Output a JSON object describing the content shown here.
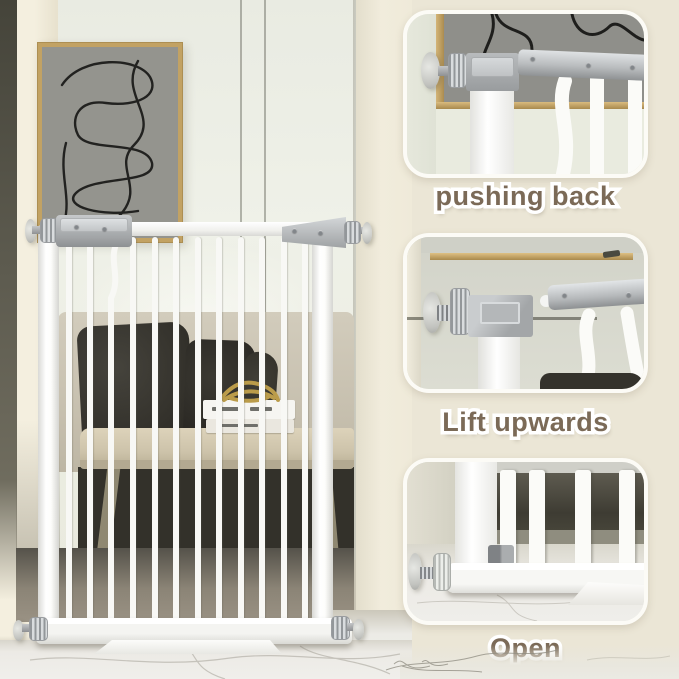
{
  "steps": [
    {
      "id": "pushing-back",
      "label": "pushing back"
    },
    {
      "id": "lift-upwards",
      "label": "Lift upwards"
    },
    {
      "id": "open",
      "label": "Open"
    }
  ],
  "gate": {
    "bar_count": 12
  },
  "colors": {
    "background_cream": "#ebe6d6",
    "label_text": "#7b6a57",
    "label_outline": "#ffffff",
    "gate_white": "#f8f8f5",
    "hardware_gray": "#aaadaf",
    "frame_gold": "#c2a263",
    "art_canvas_gray": "#94948e",
    "pillow_dark": "#2e2c26",
    "sofa_beige": "#c7c0af",
    "table_wood": "#cdc3aa",
    "marble_floor": "#eceae5"
  }
}
